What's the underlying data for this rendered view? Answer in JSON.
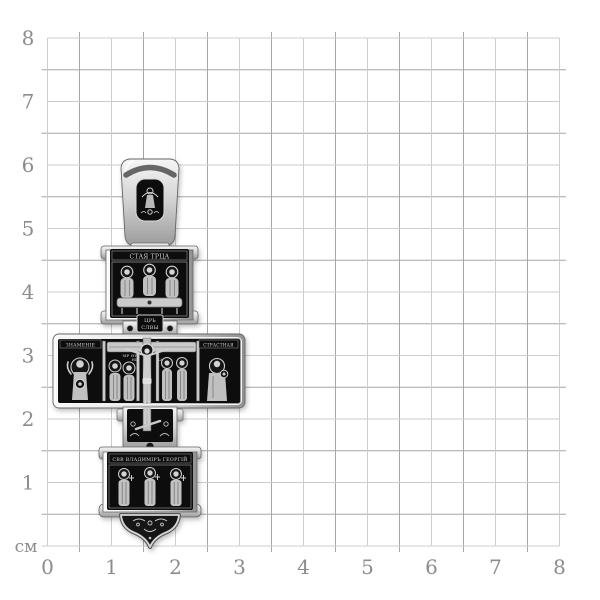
{
  "grid": {
    "unit_label": "см",
    "x_axis_labels": [
      "0",
      "1",
      "2",
      "3",
      "4",
      "5",
      "6",
      "7",
      "8"
    ],
    "y_axis_labels": [
      "8",
      "7",
      "6",
      "5",
      "4",
      "3",
      "2",
      "1"
    ],
    "unit_line_color": "#cdcdcd",
    "half_line_color": "#a6a6a6",
    "label_color": "#8c8c8c"
  },
  "pendant": {
    "subject": "oxidized-silver-orthodox-cross-pendant",
    "colors": {
      "silver_light": "#f5f5f5",
      "silver": "#c9c9c9",
      "silver_deep": "#8f8f8f",
      "oxidized_black": "#111111"
    },
    "inscriptions": {
      "top_band": "СТАЯ ТРЦА",
      "titulus_line1": "ЦРЬ",
      "titulus_line2": "СЛВЫ",
      "left_band": "ЗНАМЕНІЕ",
      "right_band": "СТРАСТНАЯ",
      "bottom_band": "СВВ ВЛАДИМІРЪ ГЕОРГІЙ",
      "mary_monogram": "МР ѲУ",
      "nika_left": "НИ",
      "nika_right": "КА"
    }
  }
}
